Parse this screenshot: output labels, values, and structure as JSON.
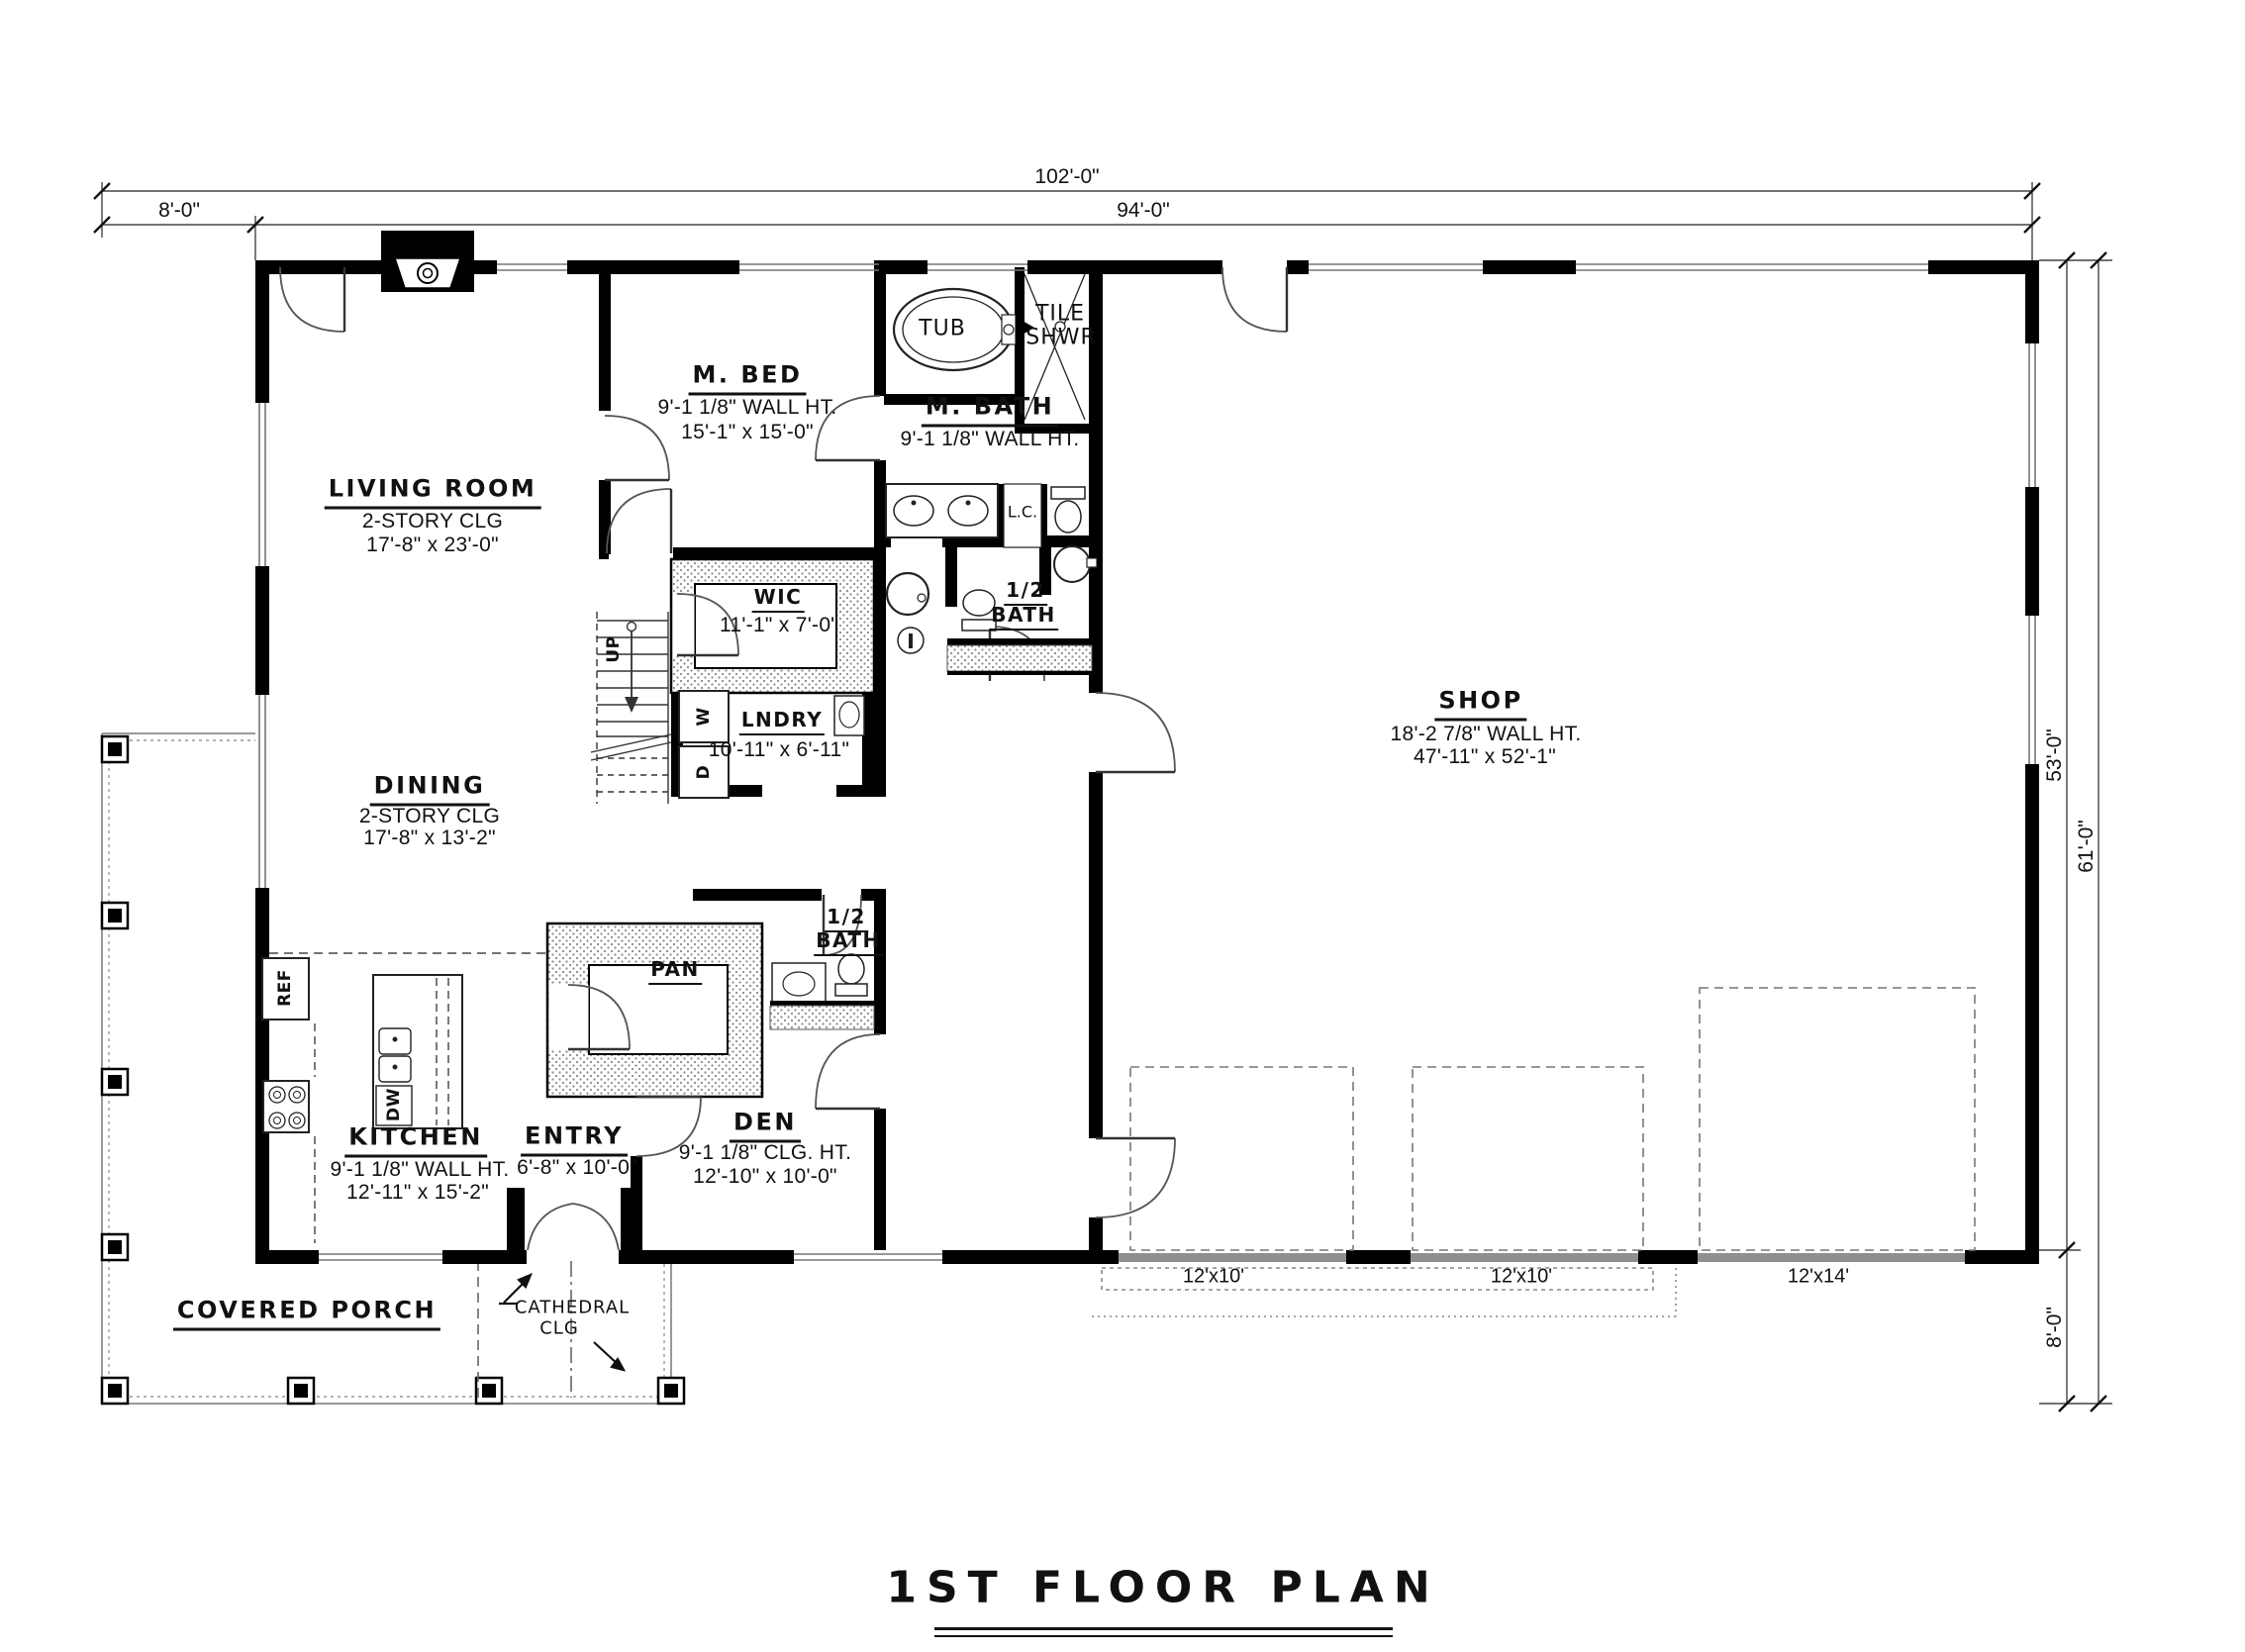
{
  "title": "1ST FLOOR PLAN",
  "dimensions": {
    "top_total": "102'-0\"",
    "top_porch": "8'-0\"",
    "top_main": "94'-0\"",
    "right_main": "53'-0\"",
    "right_total": "61'-0\"",
    "right_porch": "8'-0\""
  },
  "rooms": {
    "living": {
      "name": "LIVING ROOM",
      "ceiling": "2-STORY CLG",
      "size": "17'-8\" x 23'-0\""
    },
    "master_bed": {
      "name": "M. BED",
      "wall": "9'-1 1/8\" WALL HT.",
      "size": "15'-1\" x 15'-0\""
    },
    "master_bath": {
      "name": "M. BATH",
      "wall": "9'-1 1/8\" WALL HT."
    },
    "tub": {
      "name": "TUB"
    },
    "tile_shower": {
      "line1": "TILE",
      "line2": "SHWR"
    },
    "wic": {
      "name": "WIC",
      "size": "11'-1\" x 7'-0\""
    },
    "laundry": {
      "name": "LNDRY",
      "size": "10'-11\" x 6'-11\""
    },
    "half_bath_upper": {
      "line1": "1/2",
      "line2": "BATH"
    },
    "linen": {
      "name": "L.C."
    },
    "shop": {
      "name": "SHOP",
      "wall": "18'-2 7/8\" WALL HT.",
      "size": "47'-11\" x 52'-1\""
    },
    "dining": {
      "name": "DINING",
      "ceiling": "2-STORY CLG",
      "size": "17'-8\" x 13'-2\""
    },
    "kitchen": {
      "name": "KITCHEN",
      "wall": "9'-1 1/8\" WALL HT.",
      "size": "12'-11\" x 15'-2\""
    },
    "entry": {
      "name": "ENTRY",
      "size": "6'-8\" x 10'-0\""
    },
    "den": {
      "name": "DEN",
      "ceiling": "9'-1 1/8\" CLG. HT.",
      "size": "12'-10\" x 10'-0\""
    },
    "pantry": {
      "name": "PAN"
    },
    "half_bath_lower": {
      "line1": "1/2",
      "line2": "BATH"
    },
    "porch": {
      "name": "COVERED PORCH"
    },
    "cathedral": {
      "line1": "CATHEDRAL",
      "line2": "CLG"
    }
  },
  "fixtures": {
    "ref": "REF",
    "dw": "DW",
    "washer": "W",
    "dryer": "D",
    "up": "UP"
  },
  "garage_doors": [
    "12'x10'",
    "12'x10'",
    "12'x14'"
  ]
}
